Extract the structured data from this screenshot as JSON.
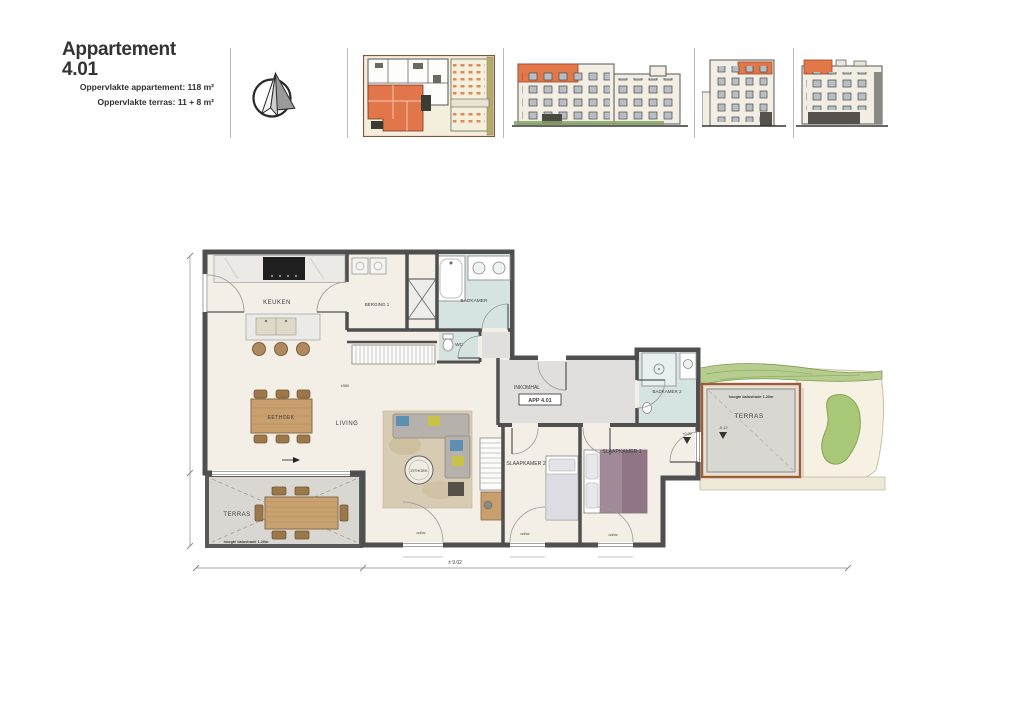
{
  "header": {
    "title": "Appartement 4.01",
    "area_line1": "Oppervlakte appartement: 118 m²",
    "area_line2": "Oppervlakte terras: 11 + 8 m²"
  },
  "thumbnails": {
    "items": [
      "site-plan-highlighted-unit",
      "elevation-street",
      "elevation-side-left",
      "elevation-side-right"
    ]
  },
  "plan": {
    "unit_label": "APP 4.01",
    "rooms": {
      "keuken": "KEUKEN",
      "berging": "BERGING 1",
      "badkamer": "BADKAMER",
      "wc": "WC",
      "eethoek": "EETHOEK",
      "living": "LIVING",
      "zithoek": "ZITHOEK",
      "inkomhal": "INKOMHAL",
      "slaapkamer2": "SLAAPKAMER 2",
      "slaapkamer1": "SLAAPKAMER 1",
      "badkamer2": "BADKAMER 2",
      "terras_left": "TERRAS",
      "terras_right": "TERRAS"
    },
    "annotations": {
      "balustrade_left": "hoogte balustrade 1.20m",
      "balustrade_right": "hoogte balustrade 1.20m",
      "level_plus": "+0.00",
      "level_minus": "-0.12",
      "odov": "od/ov",
      "dim_total": "± 9.02",
      "dim_living": "±560"
    }
  },
  "colors": {
    "accent_orange": "#e0784a",
    "wall": "#4f4f4f",
    "floor_cream": "#f3eee6",
    "floor_hall": "#e0dfde",
    "floor_bath": "#d6e4e1",
    "floor_terrace": "#d8d7d2",
    "wood": "#c89f6d",
    "green": "#a8c878",
    "balustrade_brown": "#9c5338"
  }
}
